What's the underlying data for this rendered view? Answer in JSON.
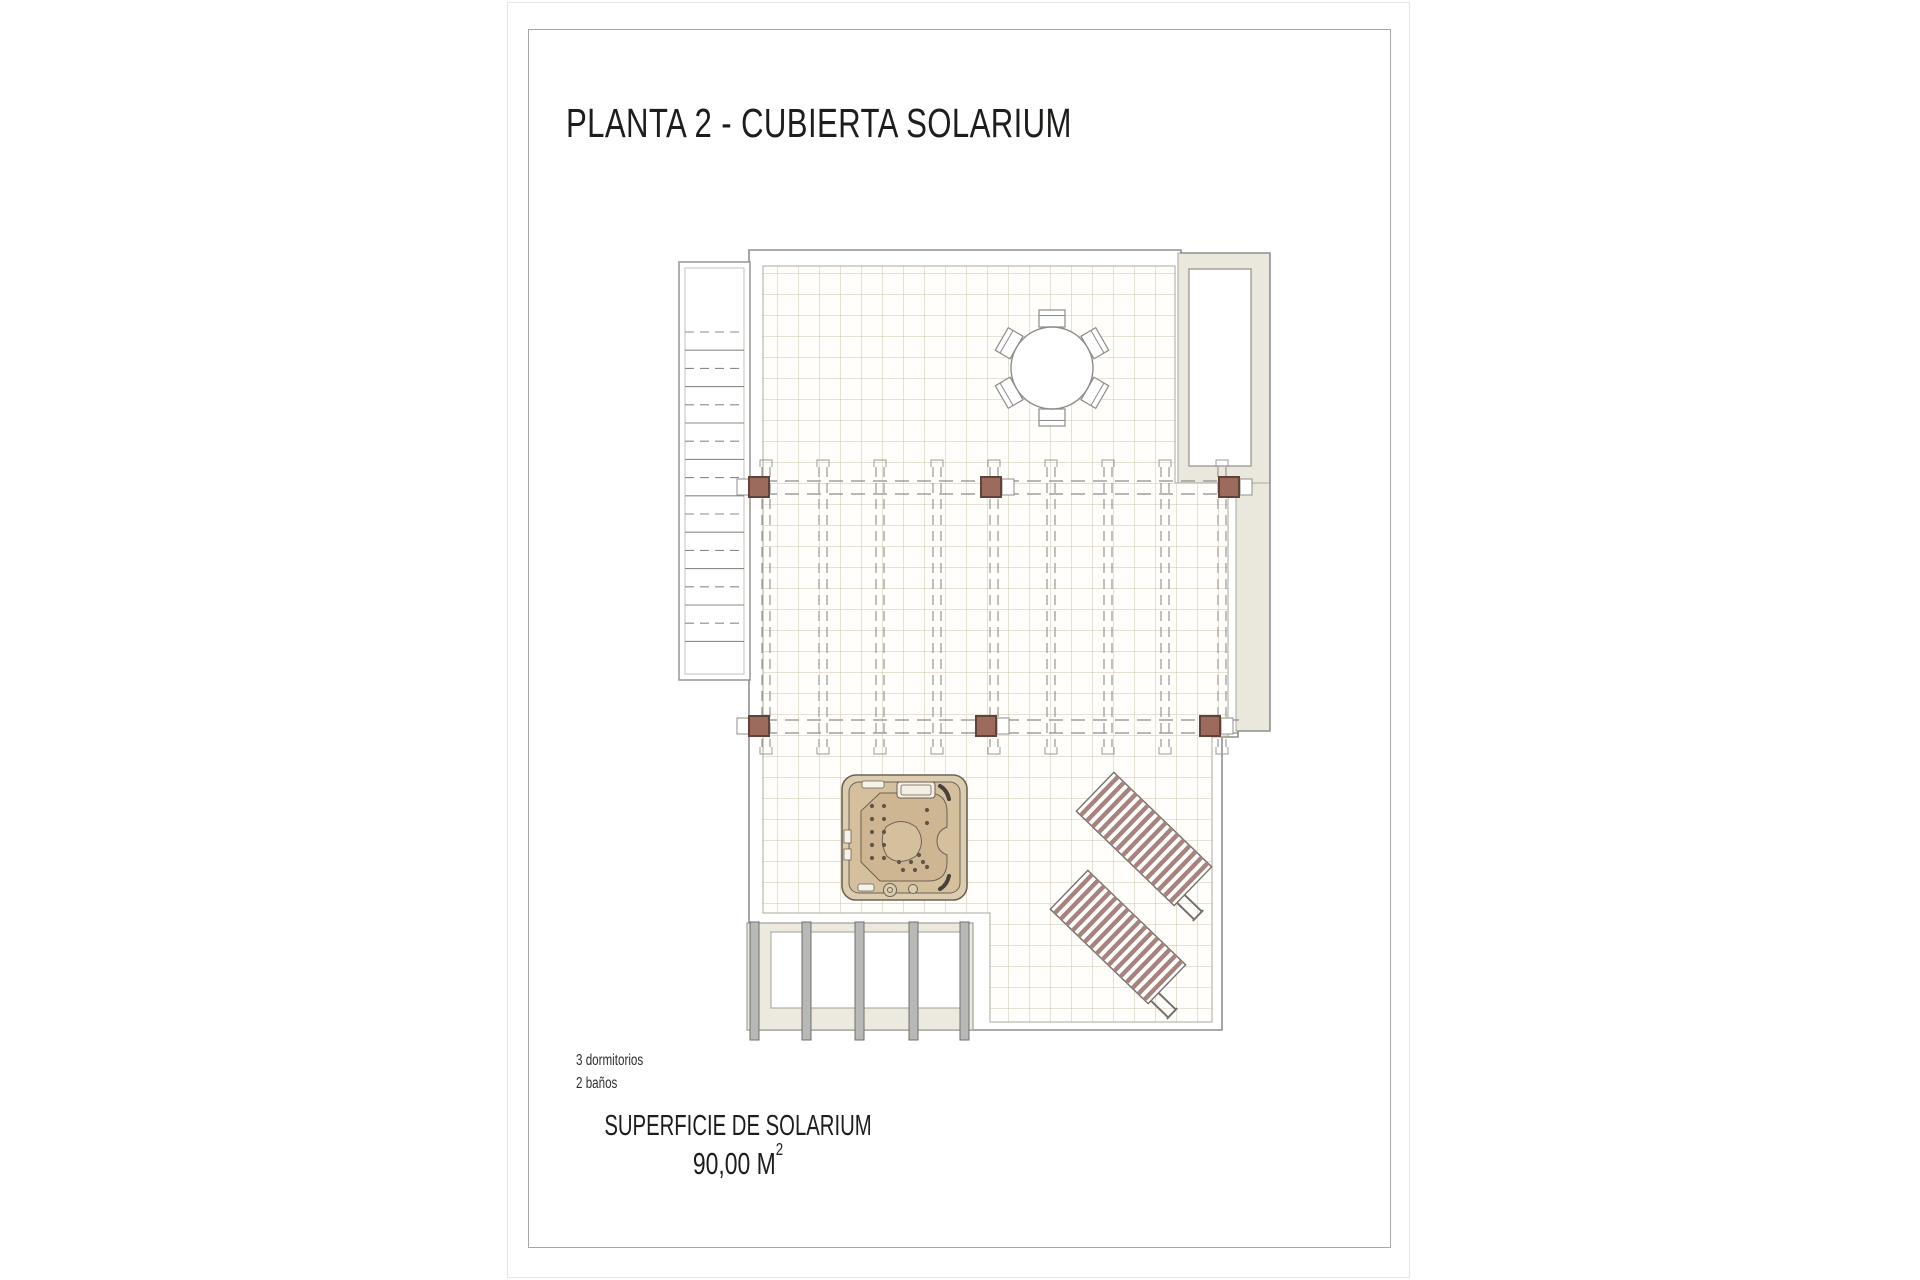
{
  "page": {
    "title": "PLANTA 2 - CUBIERTA SOLARIUM",
    "specs": {
      "bedrooms": "3 dormitorios",
      "bathrooms": "2 baños"
    },
    "area": {
      "label": "SUPERFICIE DE SOLARIUM",
      "value": "90,00 M",
      "sup": "2"
    }
  },
  "plan": {
    "features": [
      "staircase",
      "tiled-terrace",
      "pergola-beams",
      "pergola-posts-x6",
      "dining-table-with-6-chairs",
      "hot-tub",
      "sun-loungers-x2",
      "porch-columns-x5",
      "pool-enclosure",
      "side-wall"
    ],
    "colors": {
      "post": "#9c6b5e",
      "post_border": "#5f4339",
      "tile_line": "#cfc3ae",
      "outline": "#8f8f8d",
      "beige_wall": "#eae8dc",
      "lounger_slat": "#a8827c",
      "hot_tub_rim": "#dccdb0",
      "hot_tub_fill": "#d5c09e",
      "hot_tub_inner": "#cdb691",
      "porch_column": "#b8b8b6",
      "text": "#1d1d1b"
    }
  }
}
